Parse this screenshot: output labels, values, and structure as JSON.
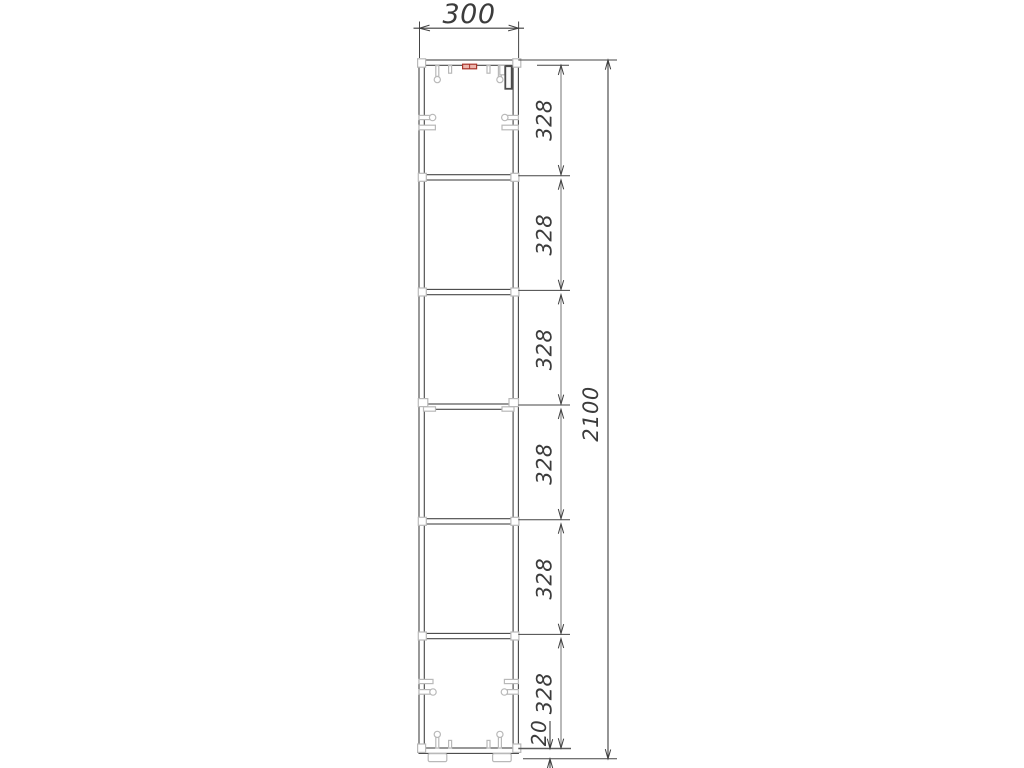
{
  "drawing": {
    "view_label": "cabinet-side-elevation"
  },
  "dimensions": {
    "width": {
      "label": "300"
    },
    "sections": [
      {
        "label": "328"
      },
      {
        "label": "328"
      },
      {
        "label": "328"
      },
      {
        "label": "328"
      },
      {
        "label": "328"
      },
      {
        "label": "328"
      }
    ],
    "plinth": {
      "label": "20"
    },
    "total": {
      "label": "2100"
    }
  },
  "colors": {
    "background": "#ffffff",
    "line": "#454545",
    "dimension": "#8a8a8a",
    "hardware": "#b9b9b9",
    "accent": "#a8352c",
    "text": "#3c3c3c"
  }
}
